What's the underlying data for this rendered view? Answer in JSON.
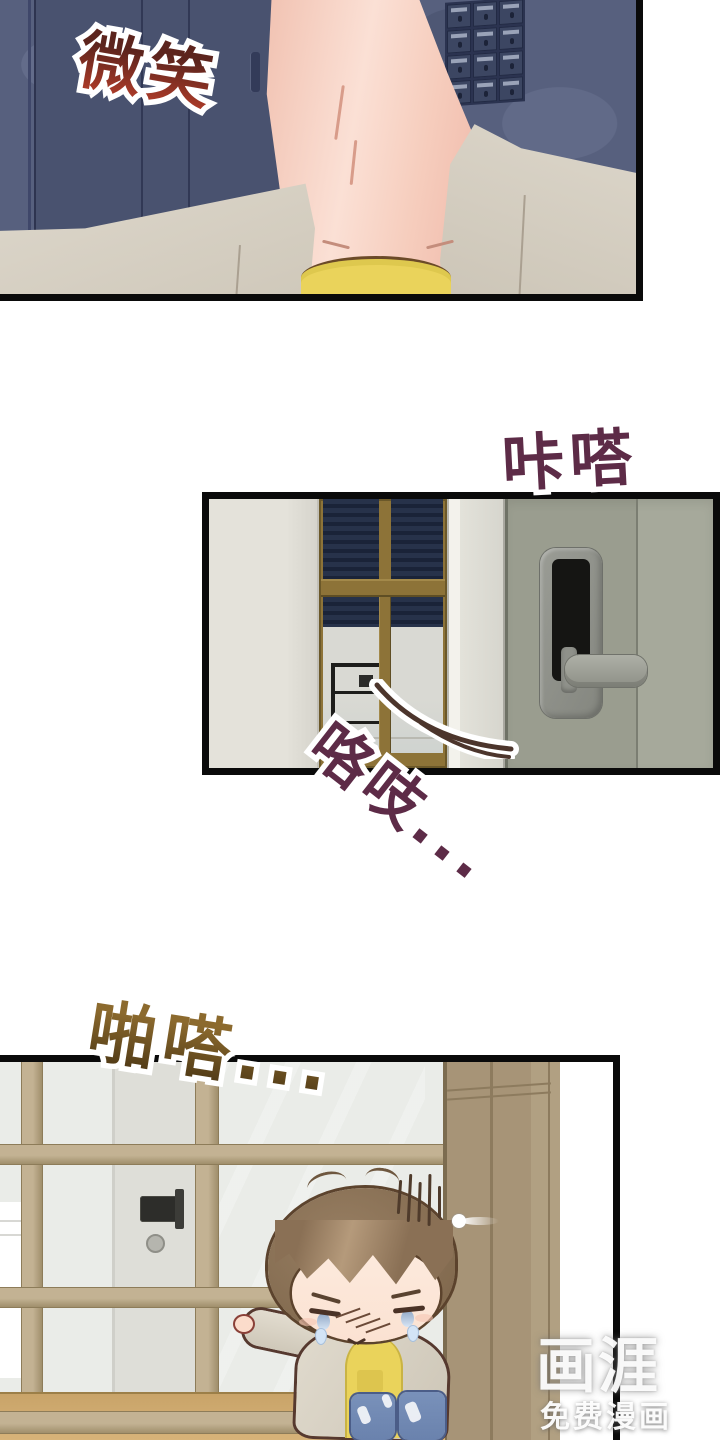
{
  "page": {
    "width_px": 720,
    "height_px": 1440,
    "background": "#ffffff",
    "type": "webtoon-comic-page"
  },
  "sound_effects": {
    "smile": {
      "text": "微笑",
      "color_top": "#5c241d",
      "color_bottom": "#a83a28",
      "outline": "#ffffff"
    },
    "click": {
      "text": "咔嗒",
      "color": "#5d2b47",
      "outline": "#ffffff"
    },
    "creak": {
      "text": "咯吱...",
      "color": "#5d2b47",
      "outline": "#ffffff"
    },
    "patter": {
      "text": "啪嗒...",
      "color_top": "#8c6a2e",
      "color_bottom": "#503a16",
      "outline": "#ffffff"
    }
  },
  "watermark": {
    "logo_text": "画涯",
    "caption_text": "免费漫画",
    "color": "#ffffff"
  },
  "icons": {
    "mailbox-grid": "grid of apartment mailboxes (css grid)",
    "smart-lock": "digital door lock with dark screen (css shape)",
    "lock-lever-handle": "horizontal lever handle (css shape)",
    "creak-swoosh-icon": "motion curve near opening door (svg path)",
    "stress-lines": "vertical irritation strokes above head (css lines)",
    "sparkle-icon": "white glint beside head (css shape)"
  },
  "palette": {
    "panel_border": "#0a0a0a",
    "corridor_wall": "#57607e",
    "corridor_door": "#49526f",
    "skin": "#f6cdbd",
    "cardigan": "#ddd7cb",
    "shirt_yellow": "#ead35b",
    "mid_door": "#9a9d8f",
    "lock_screen": "#151513",
    "window_frame_brown": "#8d7338",
    "blinds_navy": "#1f2940",
    "entry_frame_tan": "#b6a586",
    "glass": "#eaece8",
    "cabinet_tan": "#a79477",
    "floor_tan": "#cfa96f",
    "hair_brown": "#8b7157",
    "jeans_blue": "#7289b2"
  }
}
